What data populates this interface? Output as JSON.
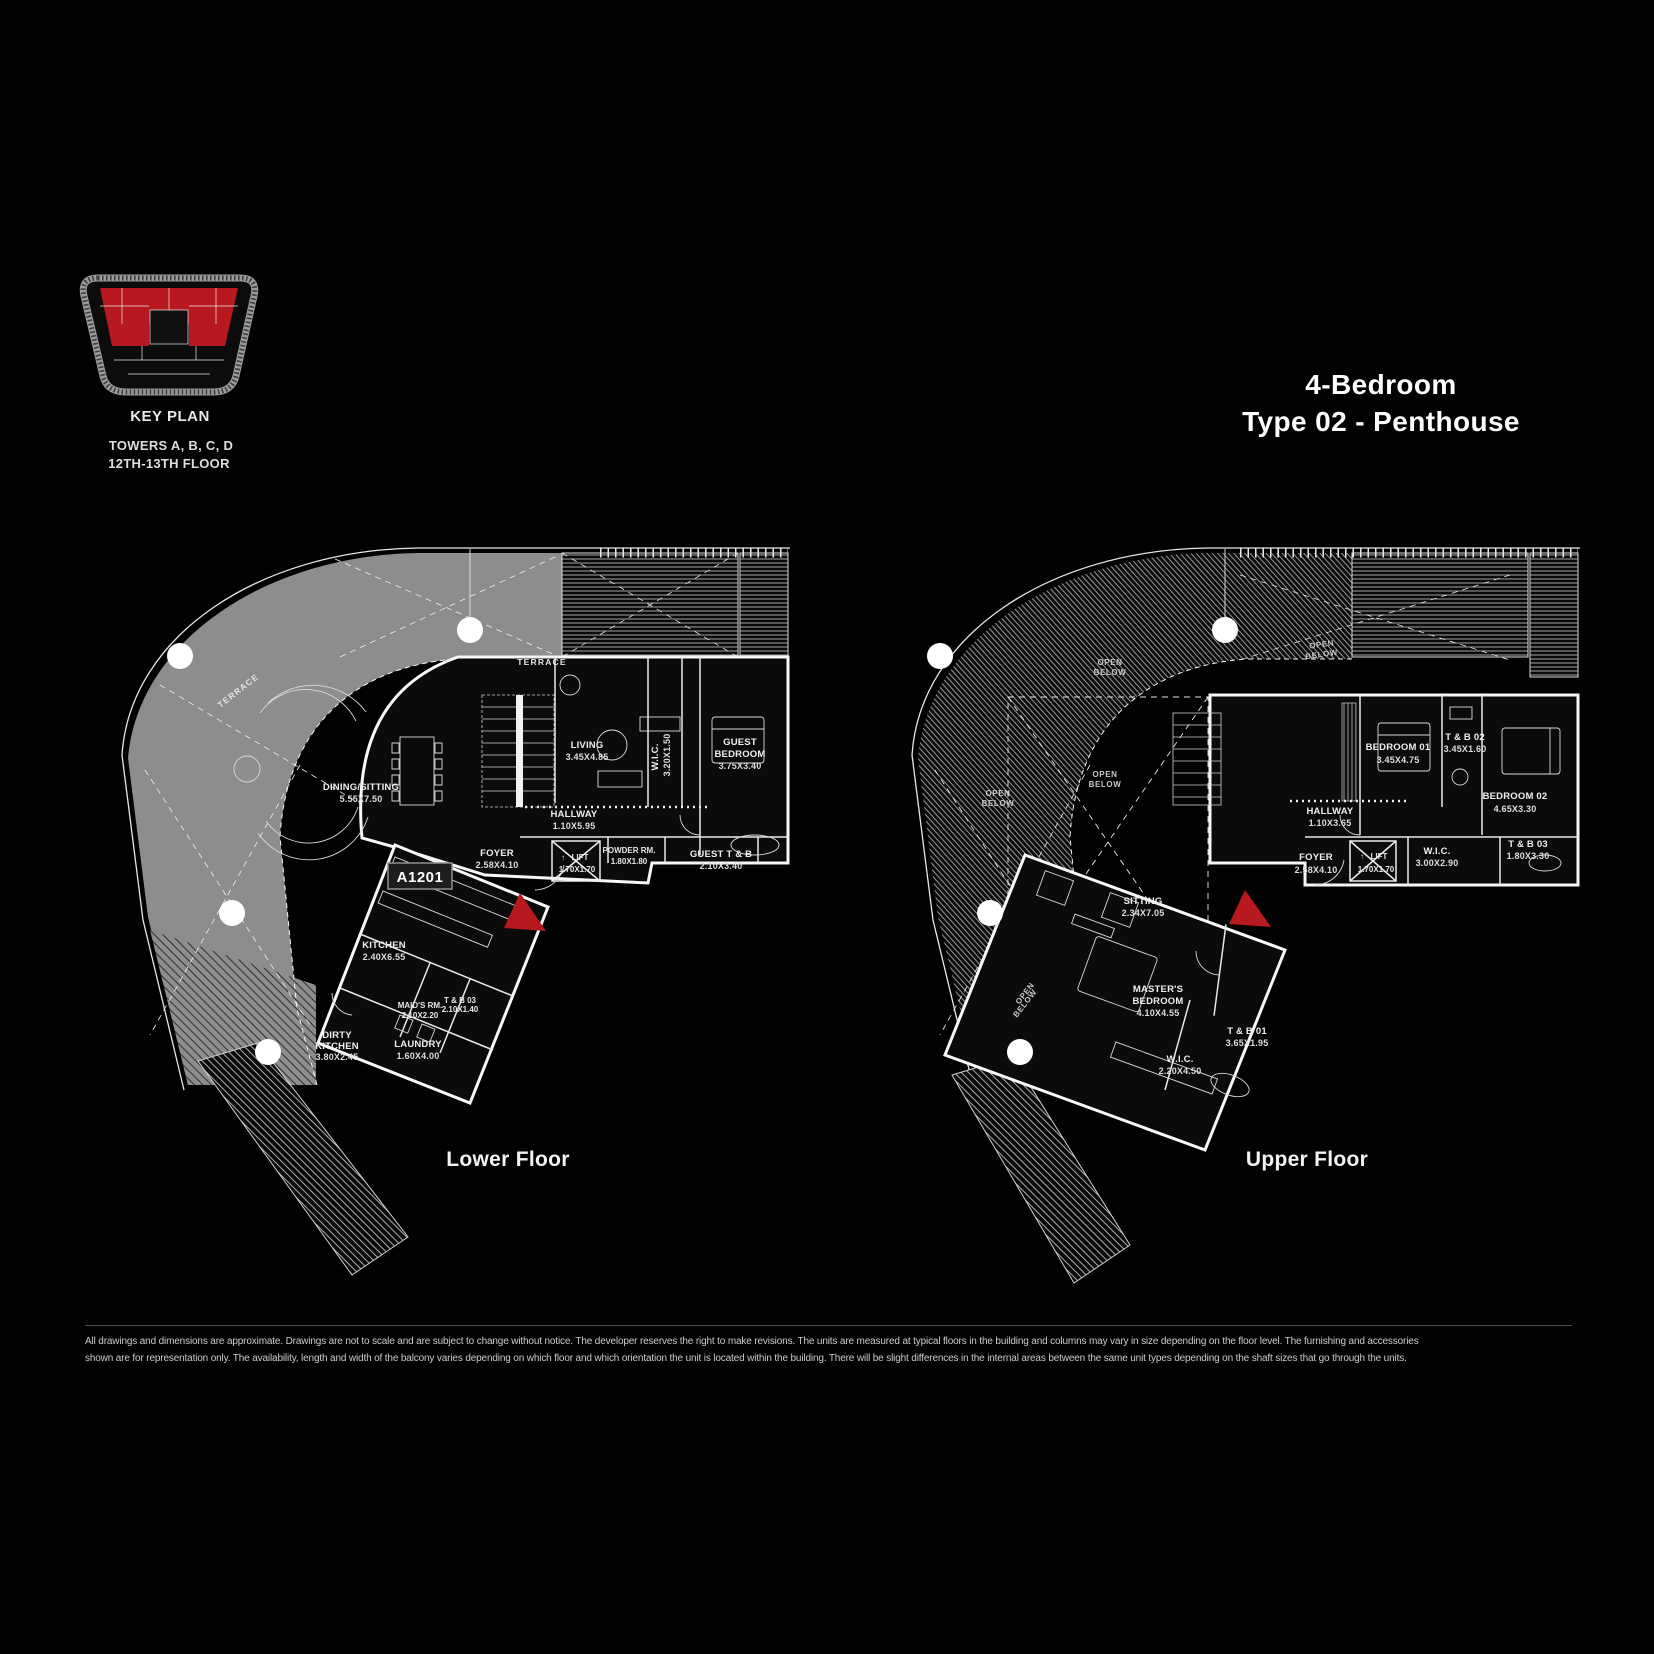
{
  "key_plan": {
    "label": "KEY PLAN",
    "towers": "TOWERS A, B, C, D",
    "floors": "12TH-13TH FLOOR",
    "highlight_color": "#b8191f"
  },
  "title": {
    "line1": "4-Bedroom",
    "line2": "Type 02 - Penthouse"
  },
  "glyphs": {
    "lift_arrow": "↑"
  },
  "colors": {
    "entry_marker_red": "#b8191f",
    "terrace_gray": "#8d8d8d"
  },
  "plans": {
    "lower": {
      "caption": "Lower Floor",
      "unit_badge": "A1201",
      "terrace_label": "TERRACE",
      "rooms": [
        {
          "n1": "DINING/SITTING",
          "d": "5.55X7.50"
        },
        {
          "n1": "LIVING",
          "d": "3.45X4.85"
        },
        {
          "n1": "W.I.C.",
          "d": "3.20X1.50"
        },
        {
          "n1": "GUEST",
          "n2": "BEDROOM",
          "d": "3.75X3.40"
        },
        {
          "n1": "HALLWAY",
          "d": "1.10X5.95"
        },
        {
          "n1": "FOYER",
          "d": "2.58X4.10"
        },
        {
          "n1": "LIFT",
          "d": "1.70X1.70"
        },
        {
          "n1": "POWDER RM.",
          "d": "1.80X1.80"
        },
        {
          "n1": "GUEST T & B",
          "d": "2.10X3.40"
        },
        {
          "n1": "KITCHEN",
          "d": "2.40X6.55"
        },
        {
          "n1": "MAID'S RM.",
          "d": "2.10X2.20"
        },
        {
          "n1": "T & B 03",
          "d": "2.10X1.40"
        },
        {
          "n1": "DIRTY",
          "n2": "KITCHEN",
          "d": "3.80X2.45"
        },
        {
          "n1": "LAUNDRY",
          "d": "1.60X4.00"
        }
      ]
    },
    "upper": {
      "caption": "Upper Floor",
      "open_below_line1": "OPEN",
      "open_below_line2": "BELOW",
      "rooms": [
        {
          "n1": "BEDROOM 01",
          "d": "3.45X4.75"
        },
        {
          "n1": "T & B 02",
          "d": "3.45X1.60"
        },
        {
          "n1": "BEDROOM 02",
          "d": "4.65X3.30"
        },
        {
          "n1": "HALLWAY",
          "d": "1.10X3.65"
        },
        {
          "n1": "FOYER",
          "d": "2.58X4.10"
        },
        {
          "n1": "LIFT",
          "d": "1.70X1.70"
        },
        {
          "n1": "W.I.C.",
          "d": "3.00X2.90"
        },
        {
          "n1": "T & B 03",
          "d": "1.80X3.30"
        },
        {
          "n1": "SITTING",
          "d": "2.34X7.05"
        },
        {
          "n1": "MASTER'S",
          "n2": "BEDROOM",
          "d": "4.10X4.55"
        },
        {
          "n1": "T & B 01",
          "d": "3.65X1.95"
        },
        {
          "n1": "W.I.C.",
          "d": "2.20X4.50"
        }
      ]
    }
  },
  "disclaimer": {
    "line1": "All drawings and dimensions are approximate. Drawings are not to scale and are subject to change without notice. The developer reserves the right to make revisions. The units are measured at typical floors in the building and columns may vary in size depending on the floor level. The furnishing and accessories",
    "line2": "shown are for representation only. The availability, length and width of the balcony varies depending on which floor and which orientation the unit is located within the building. There will be slight differences in the internal areas between the same unit types depending on the shaft sizes that go through the units."
  }
}
